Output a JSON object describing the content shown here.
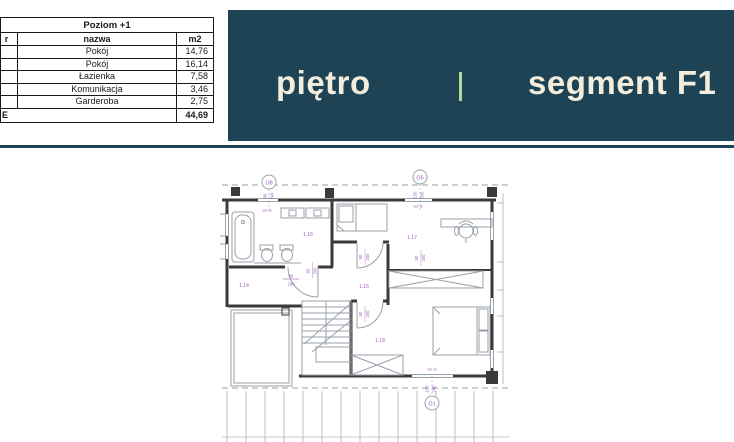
{
  "header": {
    "left_label": "piętro",
    "right_label": "segment F1"
  },
  "table": {
    "title": "Poziom +1",
    "col_nr_fragment": "r",
    "col_name": "nazwa",
    "col_area": "m2",
    "rows": [
      {
        "name": "Pokój",
        "area": "14,76"
      },
      {
        "name": "Pokój",
        "area": "16,14"
      },
      {
        "name": "Łazienka",
        "area": "7,58"
      },
      {
        "name": "Komunikacja",
        "area": "3,46"
      },
      {
        "name": "Garderoba",
        "area": "2,75"
      }
    ],
    "total_label_fragment": "E",
    "total_area": "44,69"
  },
  "plan": {
    "markers": {
      "o8": "O8",
      "o5": "O5",
      "o1": "O1"
    },
    "rooms": {
      "r14": "1.14",
      "r15": "1.15",
      "r16": "1.16",
      "r17": "1.17",
      "r18": "1.18"
    },
    "dims": {
      "d80": "80",
      "d90": "90",
      "d150": "150",
      "d200": "200",
      "d240": "240"
    },
    "level": "H+ 0"
  },
  "colors": {
    "banner_teal": "#1e4355",
    "banner_text": "#f2eddd",
    "divider_green": "#b2d69b",
    "dim_purple": "#9c5fb5"
  }
}
